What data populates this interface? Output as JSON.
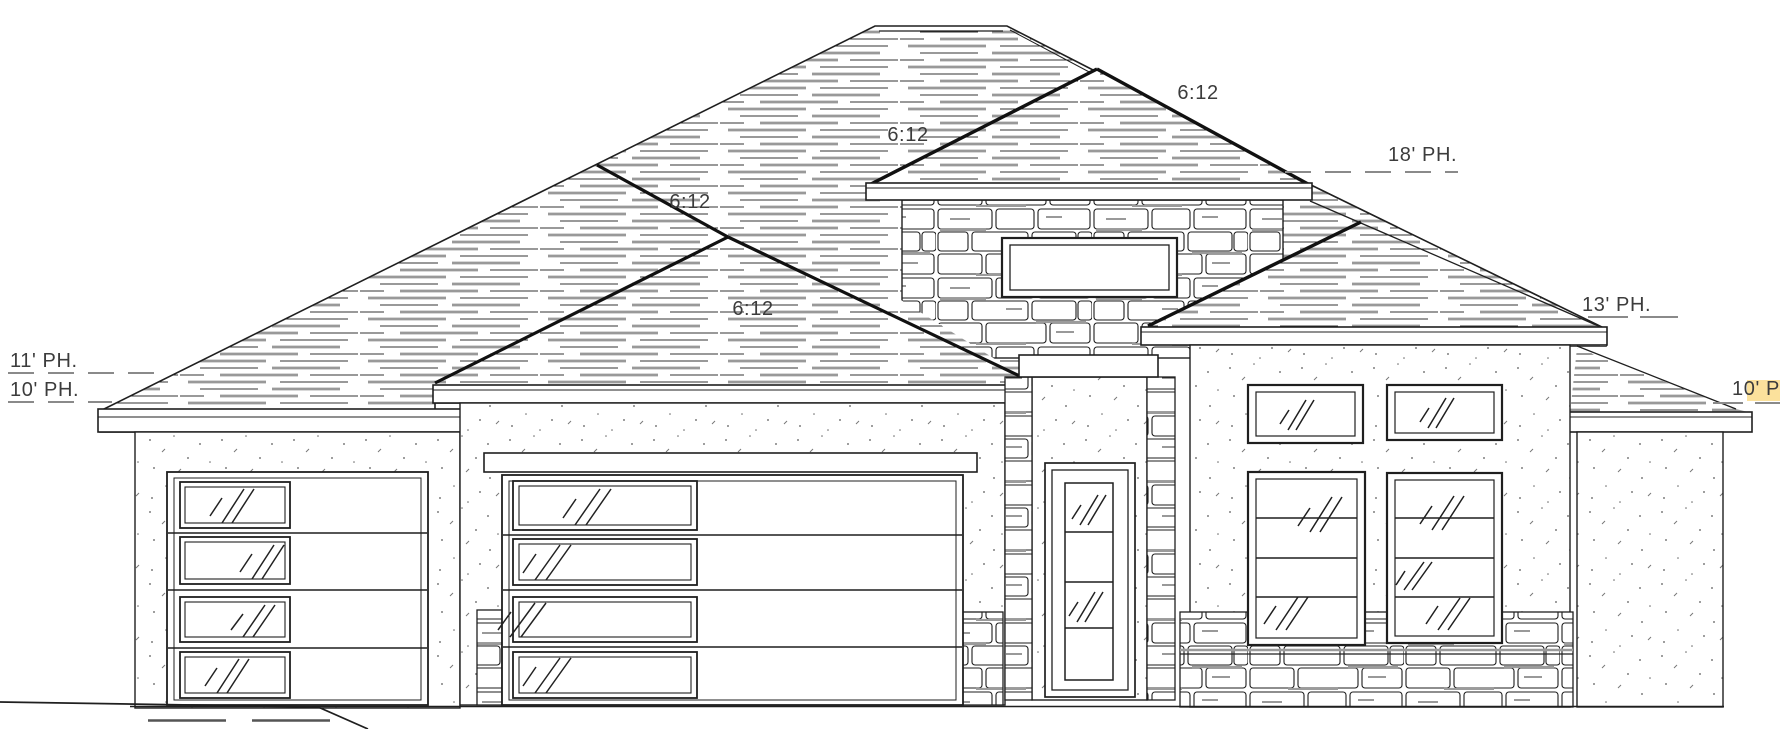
{
  "drawing": {
    "kind": "residential front elevation drawing",
    "pitch_labels": {
      "upper_right": "6:12",
      "tower_left": "6:12",
      "main_left_hip": "6:12",
      "garage_hip": "6:12"
    },
    "plate_heights": {
      "tower_18": "18' PH.",
      "right_wing_13": "13' PH.",
      "left_main_11": "11' PH.",
      "left_wing_10": "10' PH.",
      "far_right_10": "10' PH"
    },
    "colors": {
      "line": "#1f1f1f",
      "roof_shadow": "#999999",
      "label_text": "#3c3c3c",
      "highlight": "#f7c84b",
      "paper": "#ffffff"
    }
  }
}
